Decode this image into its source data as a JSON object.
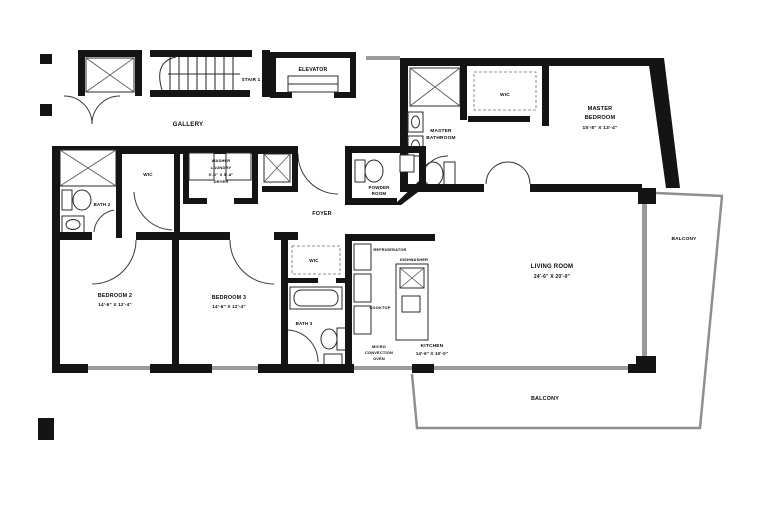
{
  "plan_title": "apartment-floor-plan",
  "colors": {
    "wall": "#141414",
    "glass": "#9a9a9a",
    "balcony_line": "#8f8f8f",
    "background": "#ffffff"
  },
  "labels": {
    "gallery": "GALLERY",
    "stair": "STAIR 1",
    "elevator": "ELEVATOR",
    "foyer": "FOYER",
    "powder_room": {
      "l1": "POWDER",
      "l2": "ROOM"
    },
    "master_bath": {
      "l1": "MASTER",
      "l2": "BATHROOM"
    },
    "master_bedroom": {
      "l1": "MASTER",
      "l2": "BEDROOM",
      "dims": "15'-8\" X 13'-4\""
    },
    "wic_master": "WIC",
    "bath2": "BATH 2",
    "wic_hall": "WIC",
    "laundry": {
      "l1": "WASHER",
      "l2": "LAUNDRY",
      "l3": "5'-0\" X 5'-8\"",
      "l4": "DRYER"
    },
    "bedroom2": {
      "name": "BEDROOM 2",
      "dims": "14'-6\" X 12'-4\""
    },
    "bedroom3": {
      "name": "BEDROOM 3",
      "dims": "14'-6\" X 12'-4\""
    },
    "wic3": "WIC",
    "bath3": "BATH 3",
    "kitchen": {
      "name": "KITCHEN",
      "dims": "14'-6\" X 10'-0\""
    },
    "refrigerator": "REFRIGERATOR",
    "dishwasher": "DISHWASHER",
    "cooktop": "COOKTOP",
    "micro": {
      "l1": "MICRO",
      "l2": "CONVECTION",
      "l3": "OVEN"
    },
    "living": {
      "name": "LIVING ROOM",
      "dims": "24'-6\" X 20'-0\""
    },
    "balcony_right": "BALCONY",
    "balcony_bottom": "BALCONY"
  }
}
